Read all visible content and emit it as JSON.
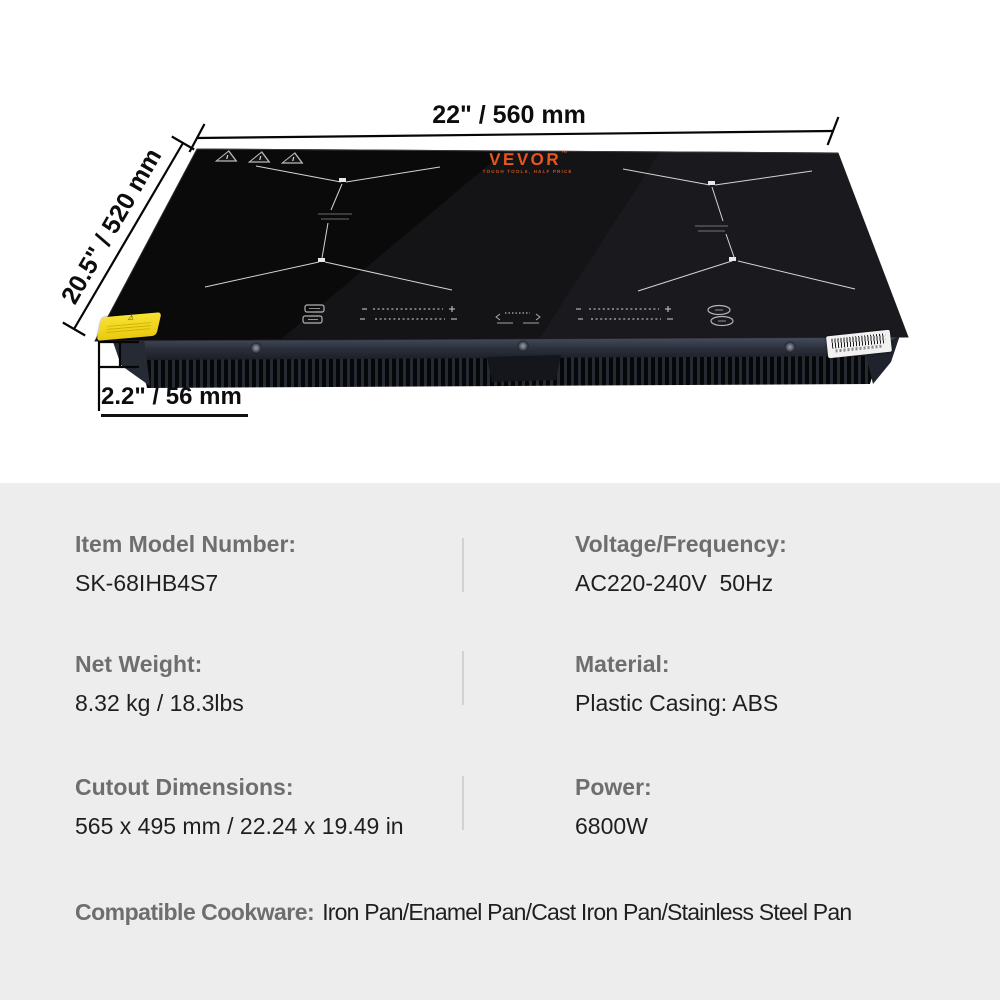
{
  "product": {
    "brand": "VEVOR",
    "brand_tm": "™",
    "brand_tagline": "TOUGH TOOLS, HALF PRICE",
    "dim_width": "22\" / 560 mm",
    "dim_depth": "20.5\" / 520 mm",
    "dim_height": "2.2\" / 56 mm"
  },
  "specs": {
    "rows": [
      {
        "label": "Item Model Number:",
        "value": "SK-68IHB4S7"
      },
      {
        "label": "Voltage/Frequency:",
        "value": "AC220-240V  50Hz"
      },
      {
        "label": "Net Weight:",
        "value": "8.32 kg / 18.3lbs"
      },
      {
        "label": "Material:",
        "value": "Plastic Casing: ABS"
      },
      {
        "label": "Cutout Dimensions:",
        "value": "565 x 495 mm / 22.24 x 19.49 in"
      },
      {
        "label": "Power:",
        "value": "6800W"
      }
    ],
    "cookware_label": "Compatible Cookware:",
    "cookware_value": "Iron Pan/Enamel Pan/Cast Iron Pan/Stainless Steel Pan"
  },
  "colors": {
    "brand_orange": "#e8561e",
    "panel_bg": "#ededed",
    "label_gray": "#6e6e6e",
    "value_black": "#1f1f1f",
    "caution_yellow": "#f5d71c",
    "glass_black": "#0a0a0b"
  }
}
